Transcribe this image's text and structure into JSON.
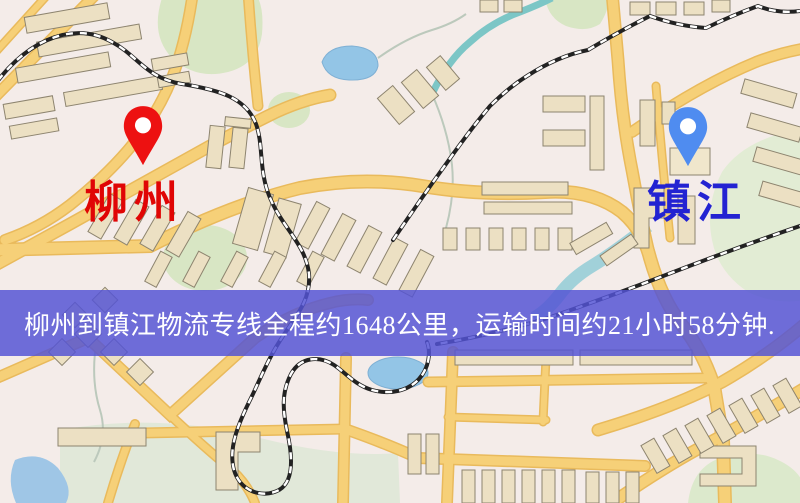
{
  "banner": {
    "text": "柳州到镇江物流专线全程约1648公里，运输时间约21小时58分钟.",
    "background_color": "#5454d4",
    "text_color": "#ffffff"
  },
  "route": {
    "origin": "柳州",
    "destination": "镇江",
    "distance_km": "1648",
    "duration_hours": "21",
    "duration_minutes": "58"
  },
  "markers": {
    "origin": {
      "label": "柳州",
      "pin_color": "#ed1111",
      "label_color": "#e00505"
    },
    "destination": {
      "label": "镇江",
      "pin_color": "#4f8cf0",
      "label_color": "#2323d2"
    }
  },
  "map": {
    "style": "street-map",
    "background_color": "#f4ece9",
    "road_color": "#f6d078",
    "water_color": "#93c5e6",
    "park_color": "#d8e6c4",
    "building_color": "#ece0c3",
    "railway_color": "#222222"
  }
}
